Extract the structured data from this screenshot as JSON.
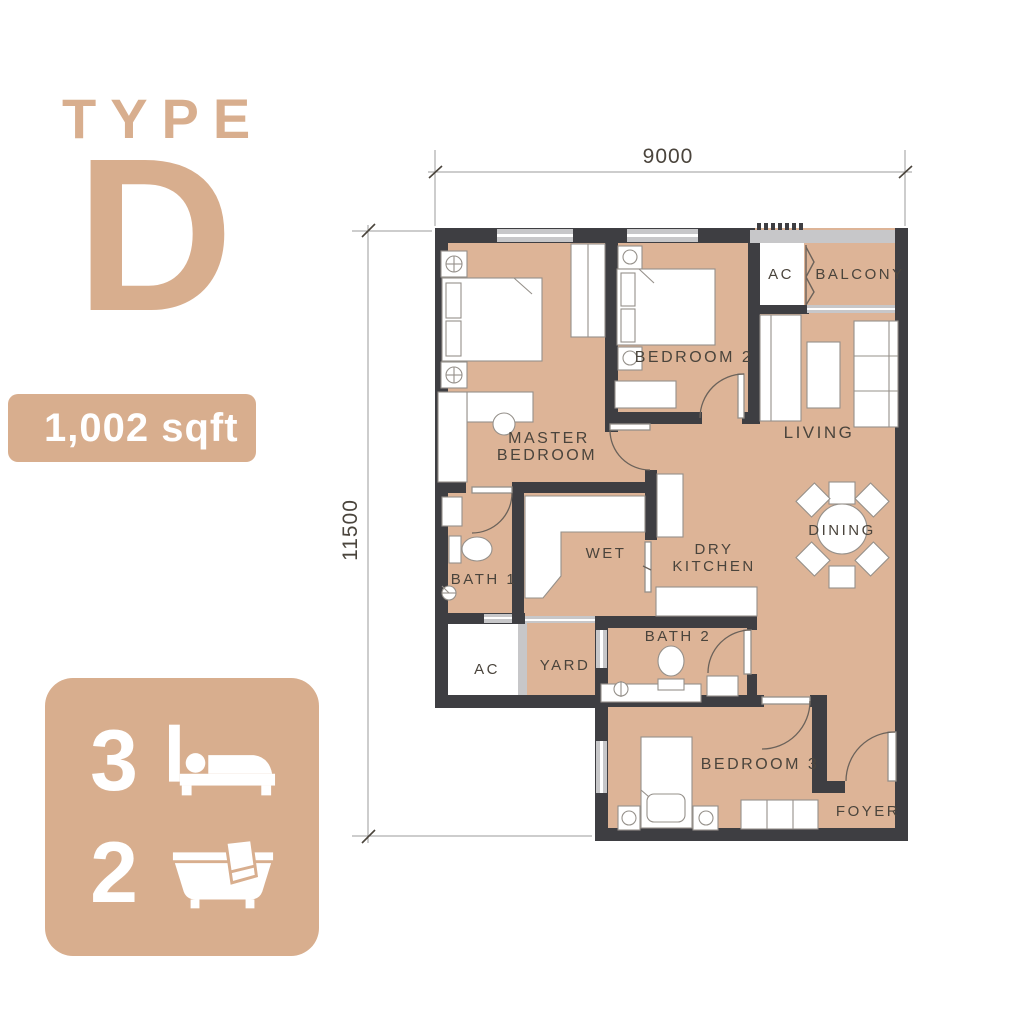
{
  "unit": {
    "type_label": "TYPE",
    "type_letter": "D",
    "area": "1,002 sqft",
    "bedrooms": "3",
    "bathrooms": "2"
  },
  "dimensions": {
    "top": "9000",
    "left": "11500"
  },
  "labels": {
    "master_line1": "MASTER",
    "master_line2": "BEDROOM",
    "bedroom2": "BEDROOM 2",
    "bedroom3": "BEDROOM 3",
    "living": "LIVING",
    "dining": "DINING",
    "balcony": "BALCONY",
    "ac_top": "AC",
    "ac_bottom": "AC",
    "wet": "WET",
    "dry_line1": "DRY",
    "dry_line2": "KITCHEN",
    "bath1": "BATH 1",
    "bath2": "BATH 2",
    "yard": "YARD",
    "foyer": "FOYER"
  },
  "colors": {
    "accent": "#d8ae8e",
    "floor": "#ddb497",
    "wall": "#3e3e42",
    "window_gray": "#c7c7c9",
    "label_text": "#4a443c"
  }
}
